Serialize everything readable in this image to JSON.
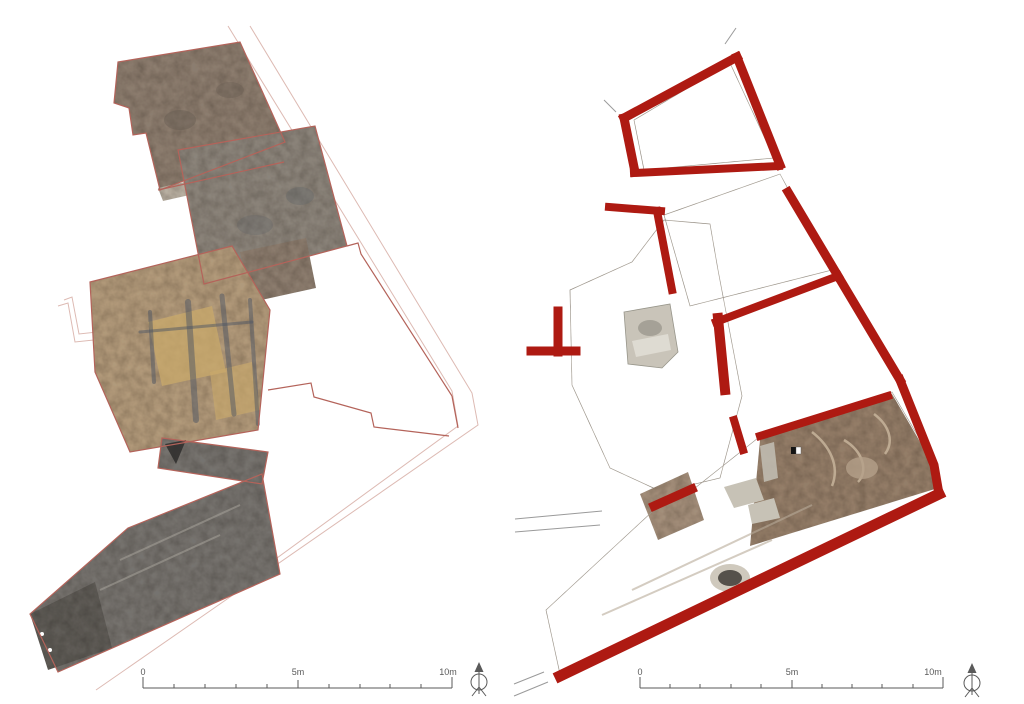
{
  "figure": {
    "type": "archaeological excavation plan, two panels",
    "panels": [
      {
        "id": "left-plan",
        "description": "orthophoto plan with thin red wall outlines"
      },
      {
        "id": "right-plan",
        "description": "orthophoto plan with thick red highlighted walls"
      }
    ]
  },
  "scalebar": {
    "labels": [
      "0",
      "5m",
      "10m"
    ]
  },
  "icons": {
    "north_arrow": "north-arrow-icon"
  },
  "colors": {
    "background": "#ffffff",
    "thin_outline": "#b4635a",
    "faint_line": "#ddbab3",
    "thick_wall": "#ae1a12",
    "scale_ink": "#5a5a5a",
    "gray_line": "#9a9a9a",
    "tex_l1": "#8b7d70",
    "tex_l2": "#8a847c",
    "tex_l3": "#b09a7c",
    "tex_l3_yellow": "#c9a96b",
    "tex_dark_streak": "#4e5563",
    "tex_stone_band": "#b7b0a4",
    "tex_street": "#757370",
    "tex_street_dark": "#5e5c58",
    "tex_r1": "#a89c8f",
    "tex_r2": "#999489",
    "tex_band": "#a28f7c",
    "tex_r4": "#937e6a",
    "tex_green": "#8c9184",
    "tex_light": "#c7c2b6",
    "tex_altar": "#c9c4b9"
  }
}
